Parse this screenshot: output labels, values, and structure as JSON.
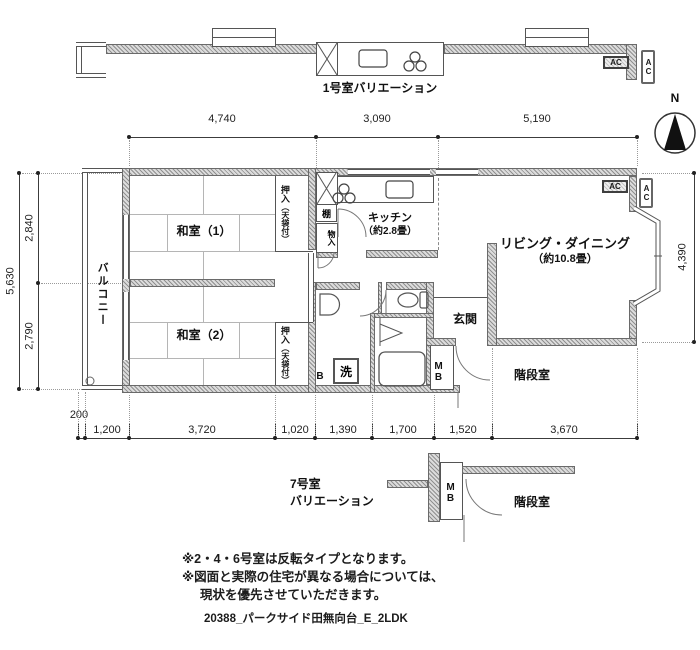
{
  "compass": {
    "north": "N"
  },
  "variation_top": {
    "label": "1号室バリエーション"
  },
  "variation_bottom": {
    "label_line1": "7号室",
    "label_line2": "バリエーション"
  },
  "dims": {
    "top": [
      "4,740",
      "3,090",
      "5,190"
    ],
    "bottom_offset": "200",
    "bottom": [
      "1,200",
      "3,720",
      "1,020",
      "1,390",
      "1,700",
      "1,520",
      "3,670"
    ],
    "left_total": "5,630",
    "left_upper": "2,840",
    "left_lower": "2,790",
    "right": "4,390"
  },
  "rooms": {
    "balcony": "バルコニー",
    "washitsu1": "和室（1）",
    "washitsu2": "和室（2）",
    "kitchen_name": "キッチン",
    "kitchen_size": "（約2.8畳）",
    "living_name": "リビング・ダイニング",
    "living_size": "（約10.8畳）",
    "genkan": "玄関",
    "stairs": "階段室",
    "closet_main": "押入",
    "closet_sub": "（天袋付）",
    "shelf": "棚",
    "storage": "物入",
    "laundry": "洗",
    "bath_mark": "B",
    "meter_box": "MB",
    "ac": "AC"
  },
  "notes": {
    "line1": "※2・4・6号室は反転タイプとなります。",
    "line2": "※図面と実際の住宅が異なる場合については、",
    "line3": "現状を優先させていただきます。"
  },
  "footer": "20388_パークサイド田無向台_E_2LDK"
}
